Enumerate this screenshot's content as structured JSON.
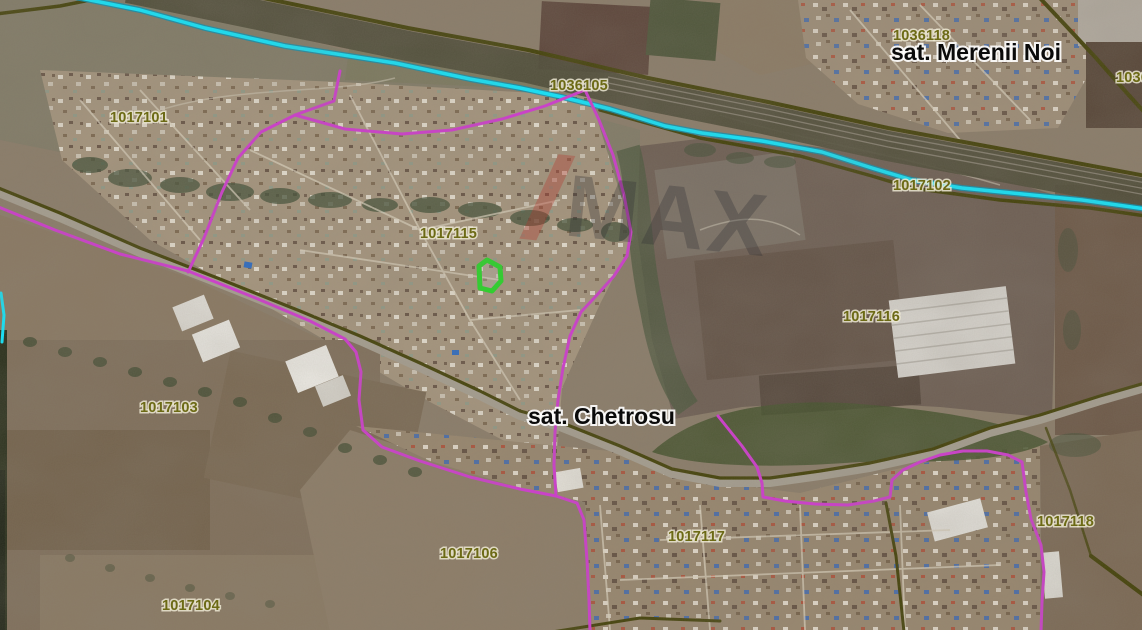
{
  "map": {
    "place_labels": [
      {
        "text": "sat. Merenii Noi"
      },
      {
        "text": "sat. Chetrosu"
      }
    ],
    "parcel_labels": [
      {
        "code": "1036118"
      },
      {
        "code": "1036105"
      },
      {
        "code": "1036"
      },
      {
        "code": "1017101"
      },
      {
        "code": "1017102"
      },
      {
        "code": "1017103"
      },
      {
        "code": "1017104"
      },
      {
        "code": "1017106"
      },
      {
        "code": "1017115"
      },
      {
        "code": "1017116"
      },
      {
        "code": "1017117"
      },
      {
        "code": "1017118"
      }
    ],
    "watermark": {
      "letters": "MAX"
    },
    "colors": {
      "cadastral_boundary": "#cf3ccf",
      "stream": "#12e4fb",
      "road_field_boundary": "#45430b",
      "parcel_code_text": "#6c6a15",
      "place_name_text": "#0a0a0a",
      "selected_parcel_outline": "#27d627",
      "watermark_slash": "#b5342b",
      "watermark_text": "#2e2e33"
    }
  }
}
